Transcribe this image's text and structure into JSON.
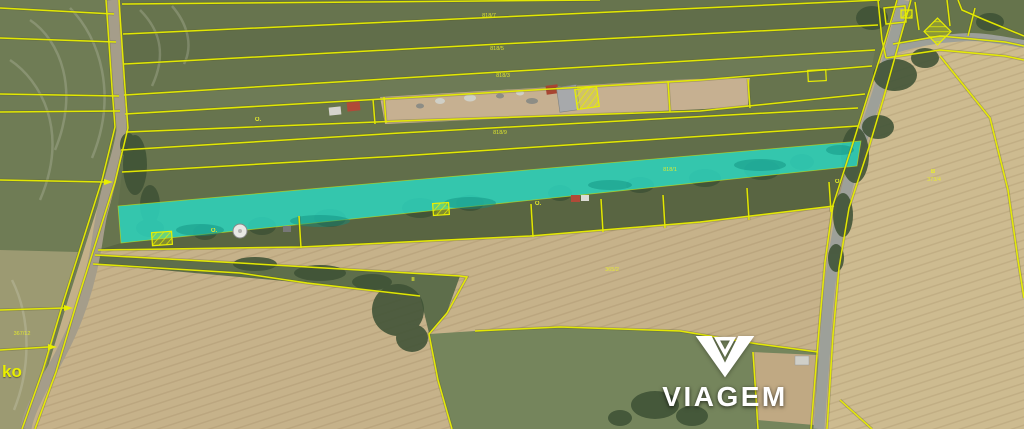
{
  "colors": {
    "yellow": "#e9ef00",
    "cyan": "#2ed1bb",
    "road": "#9da099",
    "logo": "#ffffff",
    "label": "#e9ef2a"
  },
  "watermark": {
    "brand": "VIAGEM"
  },
  "map": {
    "area_label_partial": "ko",
    "highlighted_parcel": {
      "color": "#2ed1bb",
      "label": "818/1"
    },
    "parcel_labels": [
      {
        "text": "818/7",
        "x": 489,
        "y": 17
      },
      {
        "text": "818/5",
        "x": 497,
        "y": 50
      },
      {
        "text": "818/3",
        "x": 503,
        "y": 77
      },
      {
        "text": "818/9",
        "x": 500,
        "y": 134
      },
      {
        "text": "818/1",
        "x": 670,
        "y": 171,
        "color": "#8fcf9b"
      },
      {
        "text": "365/2",
        "x": 612,
        "y": 271
      },
      {
        "text": "373/4",
        "x": 934,
        "y": 181
      },
      {
        "text": "367/12",
        "x": 22,
        "y": 335
      }
    ],
    "point_symbols": [
      {
        "glyph": "O.",
        "x": 258,
        "y": 121
      },
      {
        "glyph": "O.",
        "x": 214,
        "y": 232
      },
      {
        "glyph": "O.",
        "x": 538,
        "y": 205
      },
      {
        "glyph": "O.",
        "x": 838,
        "y": 183
      },
      {
        "glyph": "II",
        "x": 413,
        "y": 281
      },
      {
        "glyph": "B",
        "x": 933,
        "y": 173
      }
    ],
    "building_markers": {
      "hatched": [
        {
          "x": 576,
          "y": 88,
          "w": 22,
          "h": 20,
          "rot": -8
        },
        {
          "x": 152,
          "y": 232,
          "w": 20,
          "h": 13,
          "rot": -4
        },
        {
          "x": 433,
          "y": 203,
          "w": 16,
          "h": 12,
          "rot": -4
        },
        {
          "x": 928,
          "y": 22,
          "w": 19,
          "h": 19,
          "rot": 45
        },
        {
          "x": 901,
          "y": 10,
          "w": 11,
          "h": 8,
          "rot": 0
        }
      ],
      "outlined": [
        {
          "x": 808,
          "y": 70,
          "w": 18,
          "h": 11,
          "rot": -3
        }
      ]
    }
  }
}
